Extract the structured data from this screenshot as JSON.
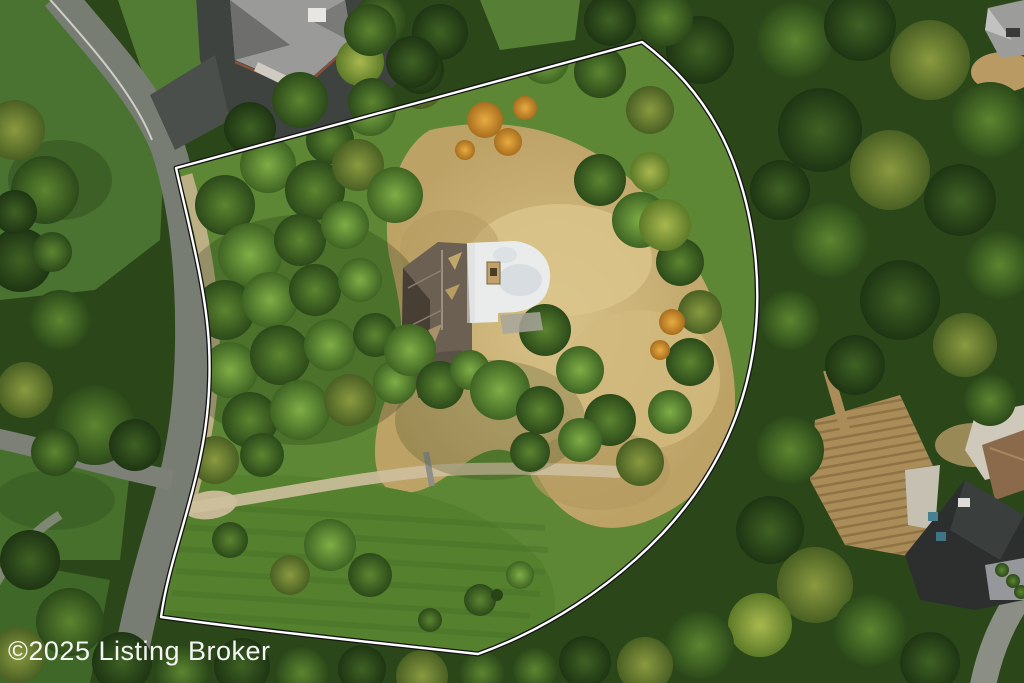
{
  "watermark": {
    "text": "©2025 Listing Broker",
    "color": "#ffffff"
  },
  "boundary": {
    "line_color": "#ffffff",
    "outline_color": "#141414"
  },
  "scene": {
    "type": "aerial-drone-photo",
    "description": "Overhead aerial photo of a wooded residential lot outlined with a white property-boundary overlay; curving road on the left, dense forest on the right, home with white rounded roof and dark shingled roof at center",
    "season_hint": "early autumn (orange and yellow-green canopy patches)",
    "features": [
      "property-boundary-outline",
      "main-house-white-roof",
      "main-house-shingle-roof",
      "gravel-driveway",
      "dry-meadow",
      "mowed-lawn",
      "curving-street",
      "neighbor-house-north",
      "neighbor-house-southeast",
      "neighbor-house-northeast",
      "row-crop-field",
      "forest-canopy"
    ]
  },
  "palette": {
    "forest_dark": "#1e3513",
    "forest_mid": "#3c6328",
    "canopy_bright": "#7fae46",
    "canopy_yellow": "#a9b84f",
    "autumn_orange": "#dd9c33",
    "meadow_tan": "#ccb478",
    "lawn_green": "#4d7533",
    "road_gray": "#787d74",
    "asphalt_dark": "#3e4340",
    "roof_white": "#eaeceb",
    "roof_shingle": "#6b6052",
    "roof_neighbor_gray": "#9a9a98",
    "roof_southeast_dark": "#2c2f2e",
    "skylight_blue": "#47808f"
  }
}
